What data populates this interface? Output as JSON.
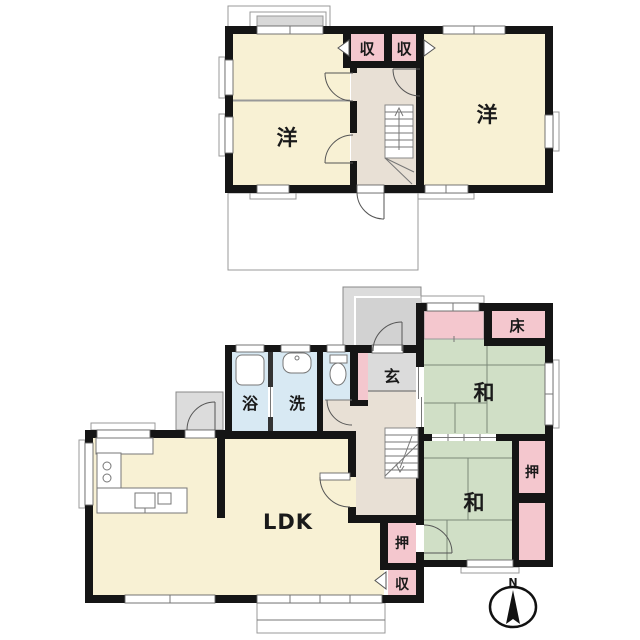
{
  "plan": {
    "floor2": {
      "west_room_label": "洋",
      "east_room_label": "洋",
      "closet_left_label": "収",
      "closet_right_label": "収"
    },
    "floor1": {
      "ldk_label": "LDK",
      "bath_label": "浴",
      "wash_label": "洗",
      "entrance_label": "玄",
      "japanese_room_north_label": "和",
      "japanese_room_south_label": "和",
      "tokonoma_label": "床",
      "oshiire_east_label": "押",
      "oshiire_hall_label": "押",
      "storage_hall_label": "収"
    },
    "compass": {
      "north_label": "N"
    },
    "colors": {
      "room_cream": "#F8F1D4",
      "closet_pink": "#F4C7CE",
      "tatami_green": "#D0DFC6",
      "wet_area_blue": "#D8E9F3",
      "entry_gray": "#DBDBDB",
      "hall_beige": "#E8E0D5",
      "wall": "#151515"
    }
  }
}
